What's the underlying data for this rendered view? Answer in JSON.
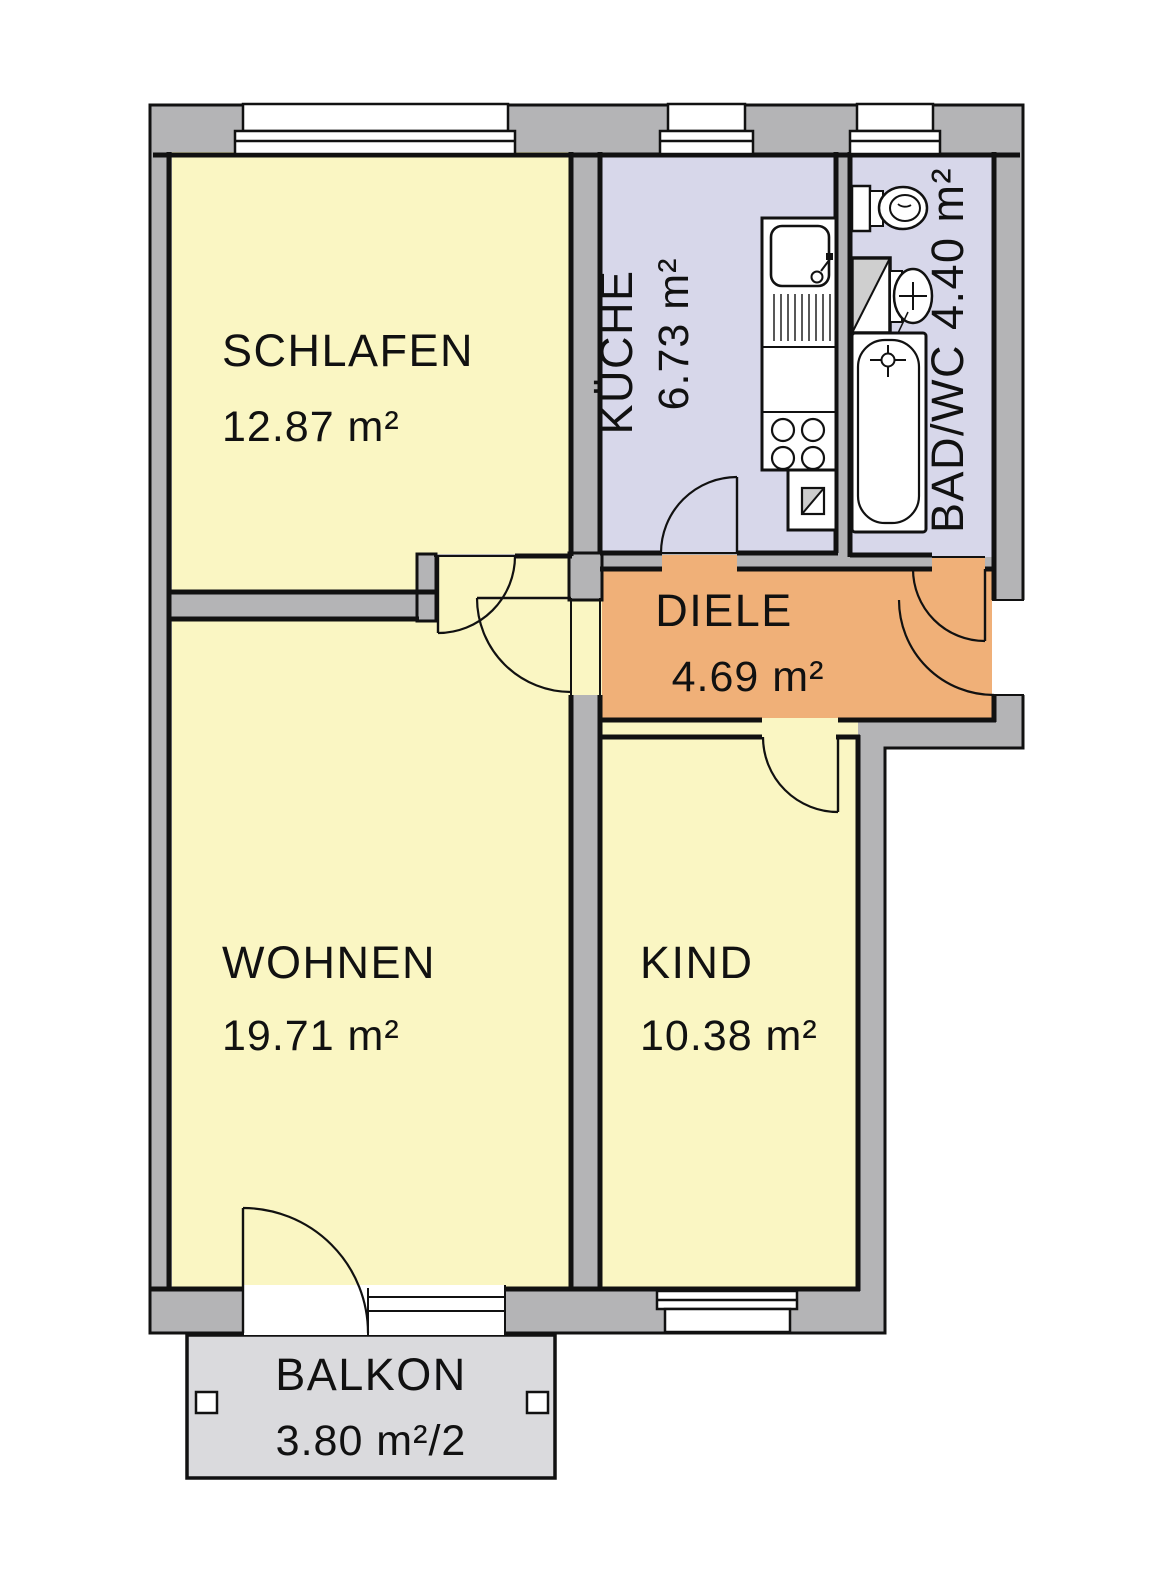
{
  "plan": {
    "type": "apartment-floor-plan",
    "colors": {
      "wall_gray": "#b4b4b6",
      "balcony_gray": "#dadadd",
      "room_yellow": "#faf6c3",
      "room_lavender": "#d7d7ea",
      "room_orange": "#f0b078",
      "outline_black": "#111111",
      "white": "#ffffff"
    },
    "rooms": [
      {
        "id": "schlafen",
        "label": "SCHLAFEN",
        "area": "12.87 m²"
      },
      {
        "id": "kueche",
        "label": "KÜCHE",
        "area": "6.73 m²"
      },
      {
        "id": "bad",
        "label": "BAD/WC",
        "area": "4.40 m²",
        "combined": "BAD/WC 4.40 m²"
      },
      {
        "id": "diele",
        "label": "DIELE",
        "area": "4.69 m²"
      },
      {
        "id": "wohnen",
        "label": "WOHNEN",
        "area": "19.71 m²"
      },
      {
        "id": "kind",
        "label": "KIND",
        "area": "10.38 m²"
      },
      {
        "id": "balkon",
        "label": "BALKON",
        "area": "3.80 m²/2"
      }
    ],
    "fixtures": [
      "kitchen-counter",
      "kitchen-sink",
      "kitchen-drainer",
      "kitchen-stove-4-burners",
      "kitchen-base-cabinet",
      "toilet",
      "shower-tray",
      "washbasin",
      "bathtub"
    ],
    "openings": [
      "schlafen-door",
      "wohnen-door",
      "kueche-door",
      "bad-door",
      "kind-door",
      "entrance-door",
      "balcony-door",
      "schlafen-window",
      "kueche-window",
      "bad-window",
      "kind-window",
      "balcony-window"
    ]
  }
}
